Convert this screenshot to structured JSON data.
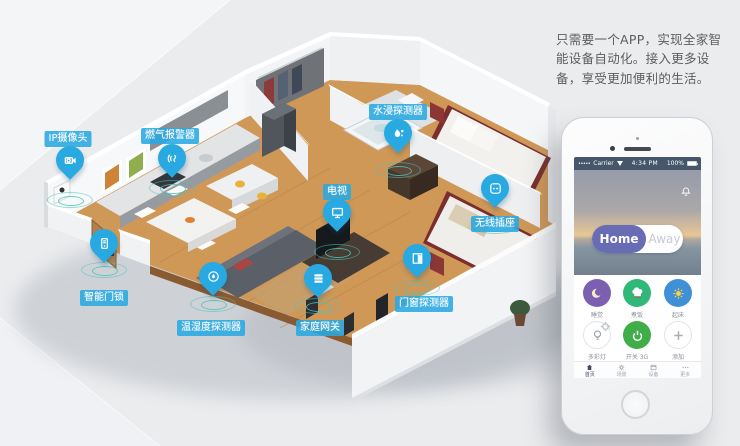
{
  "intro_text": "只需要一个APP，实现全家智能设备自动化。接入更多设备，享受更加便利的生活。",
  "colors": {
    "pin_blue": "#29a9e1",
    "ripple_teal": "#4ec3bb",
    "home_indigo": "#676cb4",
    "scene_purple": "#7d5fb2",
    "scene_green": "#2fb878",
    "scene_blue": "#4090d8",
    "power_green": "#3fae49"
  },
  "devices": [
    {
      "id": "ip-camera",
      "label": "IP摄像头",
      "icon": "video-camera"
    },
    {
      "id": "gas-alarm",
      "label": "燃气报警器",
      "icon": "gas-waves"
    },
    {
      "id": "water-sensor",
      "label": "水浸探测器",
      "icon": "water-drops"
    },
    {
      "id": "tv",
      "label": "电视",
      "icon": "tv"
    },
    {
      "id": "socket",
      "label": "无线插座",
      "icon": "socket"
    },
    {
      "id": "door-lock",
      "label": "智能门锁",
      "icon": "keypad-lock"
    },
    {
      "id": "temp-humidity",
      "label": "温湿度探测器",
      "icon": "humidity"
    },
    {
      "id": "gateway",
      "label": "家庭网关",
      "icon": "router"
    },
    {
      "id": "door-window",
      "label": "门窗探测器",
      "icon": "door-sensor"
    }
  ],
  "phone": {
    "status_bar": {
      "signal": "•••••",
      "carrier": "Carrier",
      "time": "4:34 PM",
      "battery": "100%"
    },
    "mode_toggle": {
      "home": "Home",
      "away": "Away",
      "active": "Home"
    },
    "scenes": [
      {
        "label": "睡觉",
        "icon": "moon"
      },
      {
        "label": "煮饭",
        "icon": "chef-hat"
      },
      {
        "label": "起床",
        "icon": "sun"
      },
      {
        "label": "多彩灯",
        "icon": "bulb"
      },
      {
        "label": "开关 3G",
        "icon": "power"
      },
      {
        "label": "添加",
        "icon": "plus"
      }
    ],
    "tabs": [
      {
        "label": "首页",
        "icon": "home"
      },
      {
        "label": "场景",
        "icon": "gear"
      },
      {
        "label": "设备",
        "icon": "devices"
      },
      {
        "label": "更多",
        "icon": "more"
      }
    ]
  }
}
